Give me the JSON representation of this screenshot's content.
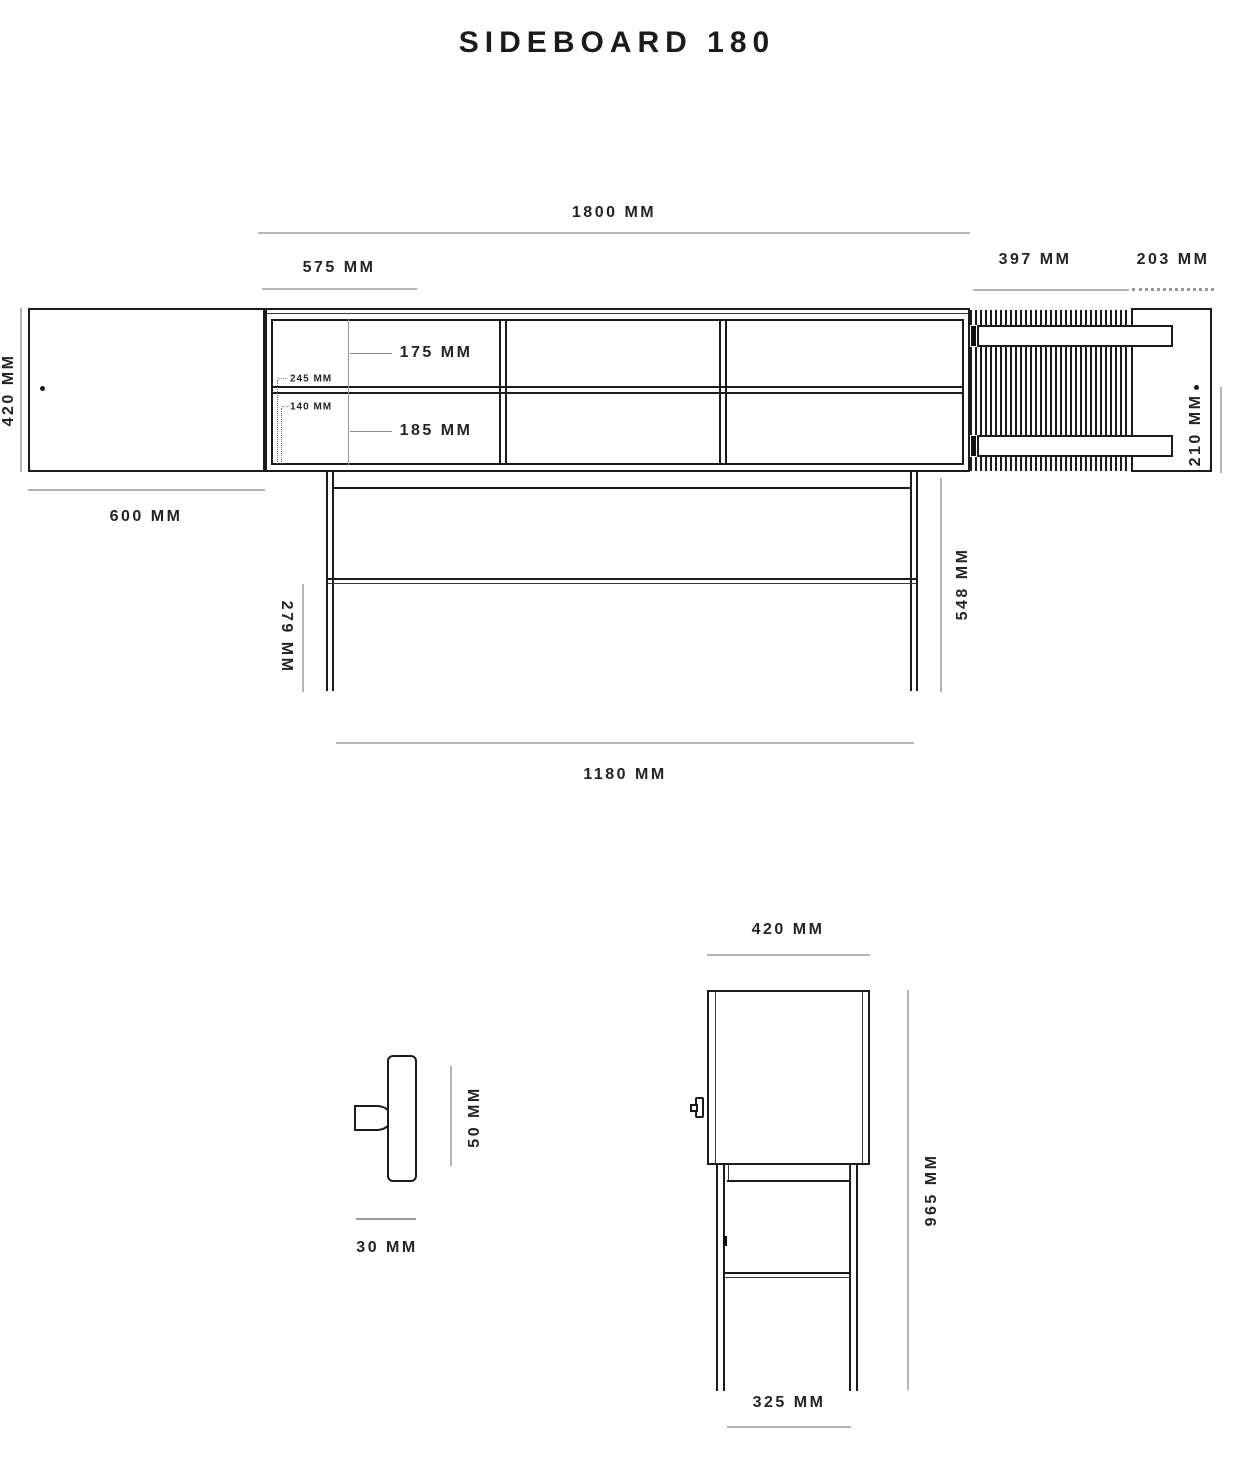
{
  "title": "SIDEBOARD 180",
  "front_view": {
    "width_total": "1800 mm",
    "width_left_bay": "575 mm",
    "width_slat_door": "397 mm",
    "width_door_opening": "203 mm",
    "height_upper_shelf": "175 mm",
    "height_lower_shelf": "185 mm",
    "depth_upper_note": "245 mm",
    "depth_lower_note": "140 mm",
    "height_cabinet": "420 mm",
    "width_hinged_door": "600 mm",
    "width_door_top_view": "210 mm",
    "height_base_frame": "548 mm",
    "height_stretcher": "279 mm",
    "width_base_frame": "1180 mm"
  },
  "handle_detail": {
    "height": "50 mm",
    "depth": "30 mm"
  },
  "side_view": {
    "depth": "420 mm",
    "height_total": "965 mm",
    "depth_base_frame": "325 mm"
  }
}
